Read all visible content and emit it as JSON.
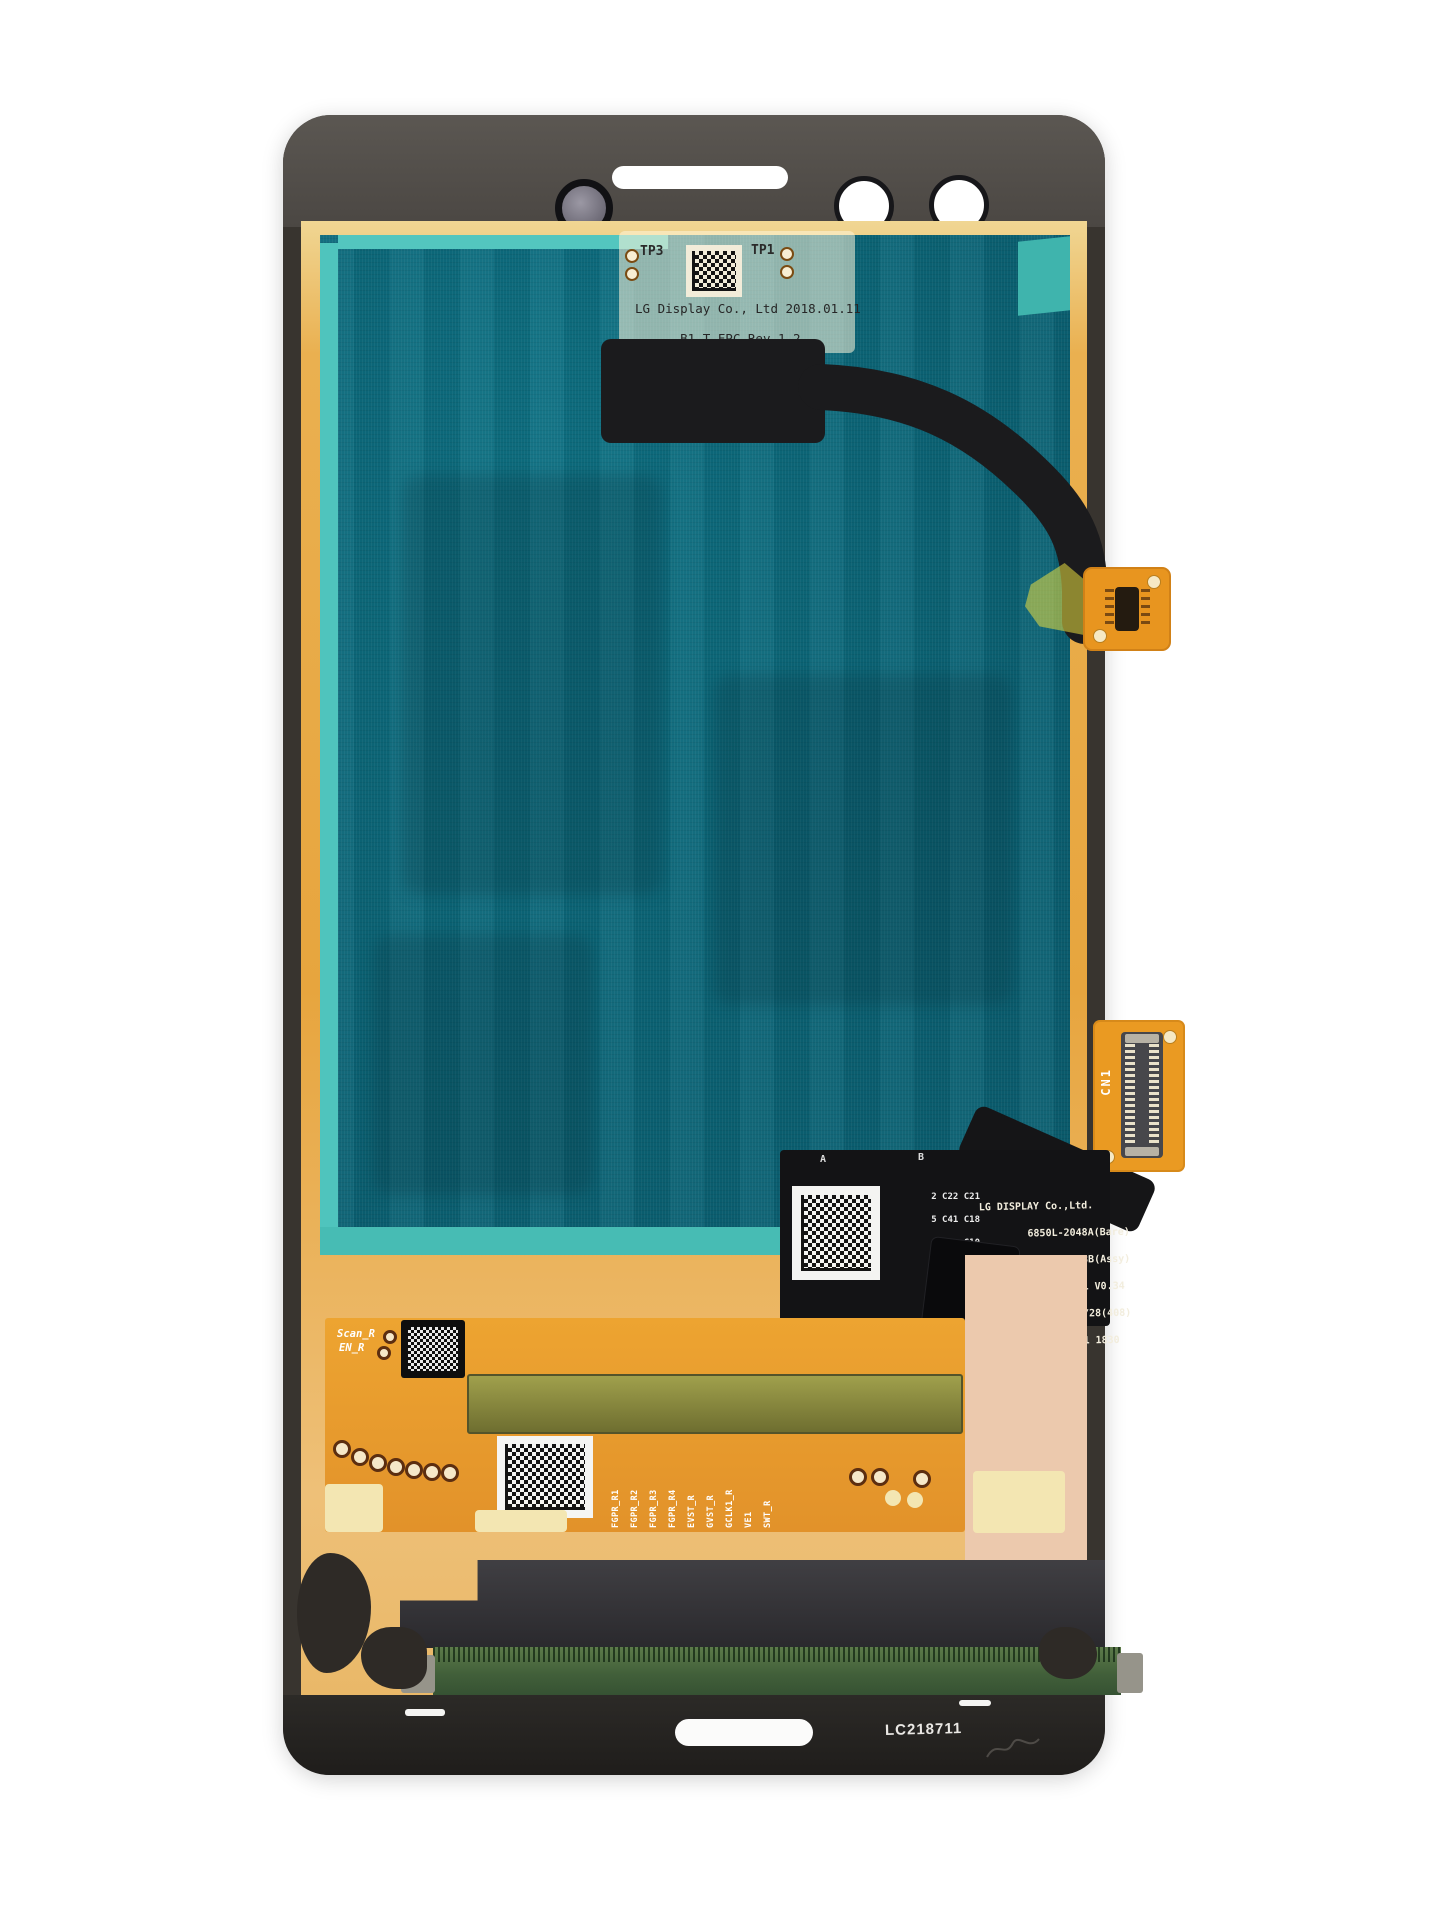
{
  "subject": "Smartphone LCD screen assembly, rear view (LG Display panel)",
  "top_flex": {
    "tp_left": "TP3",
    "tp_right": "TP1",
    "lines": [
      "LG Display Co., Ltd 2018.01.11",
      "B1 T-FPC Rev.1.2",
      "Bare,A"
    ]
  },
  "mid_flex": {
    "corner_a": "A",
    "corner_b": "B",
    "silkscreen": [
      "2 C22 C21",
      "5 C41 C18",
      "C10",
      "C19   R1",
      "C2",
      "M1"
    ],
    "print": [
      "LG DISPLAY Co.,Ltd.",
      "6850L-2048A(Bare)",
      "6841L-0728B(Assy)",
      "1-ED01-UM1 V0.34",
      "D:2018/06/28(408)",
      "NFT-MLB1◇1 1830"
    ]
  },
  "cn1_label": "CN1",
  "bottom_flex": {
    "scan_label": "Scan_R",
    "en_label": "EN_R",
    "signals": [
      "FGPR_R1",
      "FGPR_R2",
      "FGPR_R3",
      "FGPR_R4",
      "EVST_R",
      "GVST_R",
      "GCLK1_R",
      "VE1",
      "SWT_R"
    ]
  },
  "frame_serial": "LC218711",
  "colors": {
    "teal": "#0d6b7c",
    "aqua": "#4fc4bd",
    "copper": "#e7a53e",
    "orange": "#ea9a22",
    "flex_black": "#141416",
    "green_pcb": "#4a6840",
    "frame": "#38342f"
  }
}
